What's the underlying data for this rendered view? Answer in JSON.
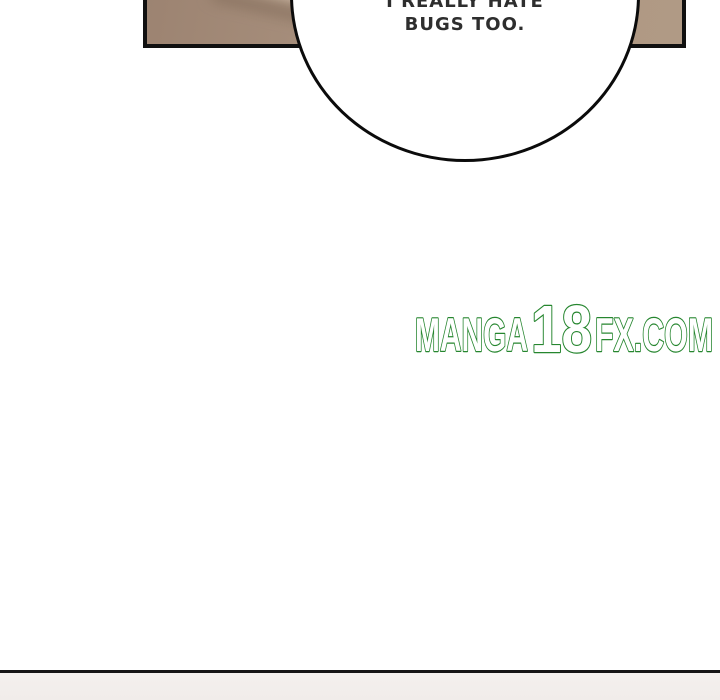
{
  "page": {
    "background_color": "#ffffff",
    "type": "manga-page-fragment"
  },
  "top_panel": {
    "fill_base_color": "#a78f7c",
    "border_color": "#101010"
  },
  "speech_bubble": {
    "line1": "I REALLY HATE",
    "line2": "BUGS TOO.",
    "text_color": "#2e2e2e",
    "fill_color": "#ffffff",
    "outline_color": "#0b0b0b"
  },
  "watermark": {
    "full_text": "MANGA18FX.COM",
    "part1": "MANGA",
    "part2": "18",
    "part3": "FX.COM",
    "fill_color": "#ffffff",
    "outline_color": "#26862f"
  },
  "next_panel": {
    "divider_color": "#161616",
    "fill_color": "#f2eeec"
  }
}
